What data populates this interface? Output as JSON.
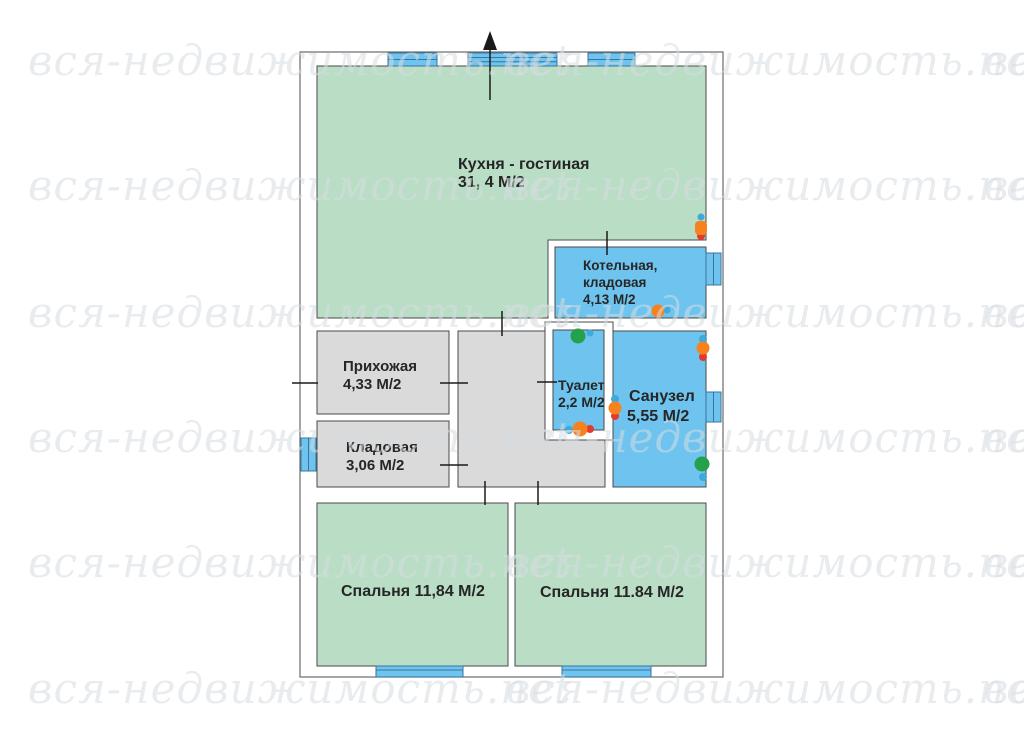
{
  "watermark": {
    "text": "вся-недвижимость.net"
  },
  "colors": {
    "room_green": "#b9ddc5",
    "room_blue": "#6ec4ee",
    "room_gray": "#dadada",
    "wall_white": "#ffffff",
    "outline": "#4a4a4a",
    "window_blue": "#6ec4ee",
    "fixture_orange": "#f5821f",
    "fixture_red": "#e23b2e",
    "fixture_blue": "#3fa9d9",
    "fixture_green": "#23a14b"
  },
  "plan": {
    "rooms": {
      "kitchen": {
        "name": "Кухня - гостиная",
        "area": "31, 4 М/2"
      },
      "boiler": {
        "name_line1": "Котельная,",
        "name_line2": "кладовая",
        "area": "4,13 М/2"
      },
      "hallway": {
        "name": "Прихожая",
        "area": "4,33 М/2"
      },
      "storage": {
        "name": "Кладовая",
        "area": "3,06 М/2"
      },
      "toilet": {
        "name": "Туалет",
        "area": "2,2 М/2"
      },
      "bathroom": {
        "name": "Санузел",
        "area": "5,55 М/2"
      },
      "bedroom_left": {
        "label": "Спальня 11,84  М/2"
      },
      "bedroom_right": {
        "label": "Спальня 11.84 М/2"
      }
    }
  }
}
